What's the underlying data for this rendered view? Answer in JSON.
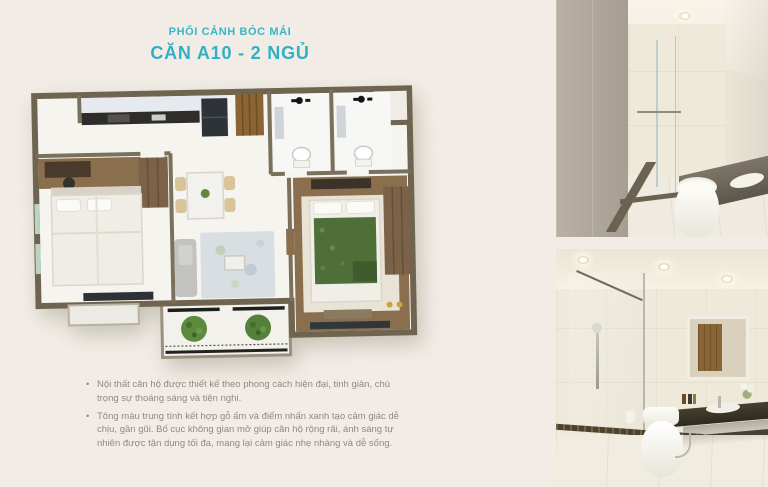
{
  "page": {
    "background_color": "#f1ede6",
    "width": 768,
    "height": 487
  },
  "header": {
    "subtitle": "PHỐI CẢNH BÓC MÁI",
    "title": "CĂN A10 - 2 NGỦ",
    "accent_color": "#2fb0c5"
  },
  "floor_plan": {
    "type": "3d-roof-removed-apartment-render",
    "rooms": [
      "kitchen",
      "entry",
      "dining-area",
      "living-room",
      "bathroom-1",
      "bathroom-2",
      "bedroom-1",
      "bedroom-2",
      "balcony"
    ],
    "colors": {
      "walls": "#6f6450",
      "floor": "#f6f4ef",
      "wood_floor": "#8a6f4e",
      "green_duvet": "#4e7038",
      "plants": "#5d8a3f",
      "accent_counter": "#2f2d2a"
    }
  },
  "description": {
    "text_color": "#8f8982",
    "bullets": [
      "Nội thất căn hộ được thiết kế theo phong cách hiện đại, tinh giản, chú trọng sự thoáng sáng và tiện nghi.",
      "Tông màu trung tính kết hợp gỗ ấm và điểm nhấn xanh tạo cảm giác dễ chịu, gần gũi. Bố cục không gian mở giúp căn hộ rộng rãi, ánh sáng tự nhiên được tận dụng tối đa, mang lại cảm giác nhẹ nhàng và dễ sống."
    ]
  },
  "photos": [
    {
      "name": "bathroom-photo-top",
      "subject": "bathroom with glass shower, toilet and stone vanity"
    },
    {
      "name": "bathroom-photo-bottom",
      "subject": "bathroom with shower column, toilet, mirror and dark vanity"
    }
  ]
}
